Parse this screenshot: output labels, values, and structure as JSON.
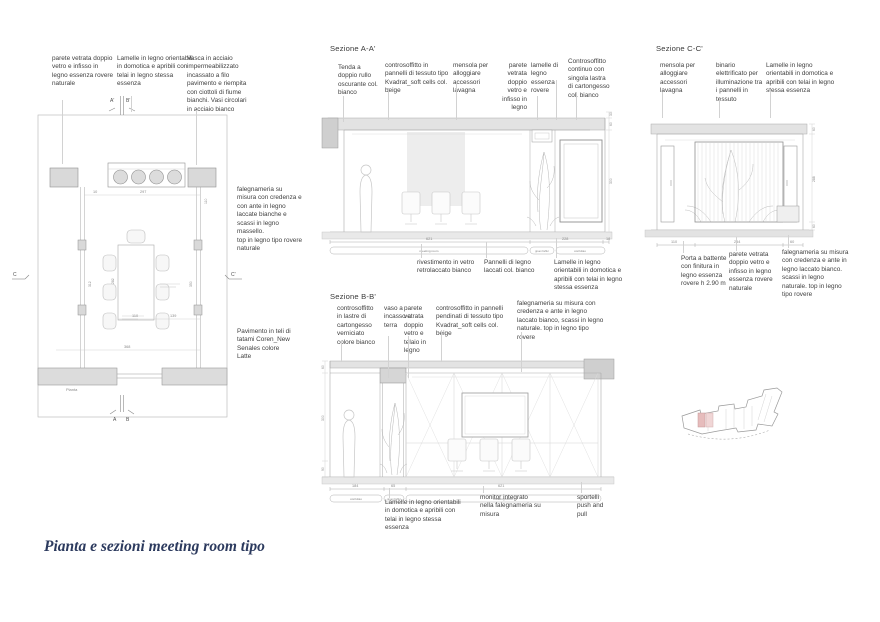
{
  "title": "Pianta e sezioni meeting room tipo",
  "colors": {
    "title_text": "#2c3a5e",
    "annotation_text": "#3f3f3f",
    "drawing_line": "#9a9a9a",
    "wall_fill": "#dcdcdc",
    "slab_fill": "#e3e3e3",
    "keyplan_highlight": "#e6bcbc"
  },
  "plan": {
    "label": "Pianta",
    "notes_top": [
      "parete vetrata doppio vetro e infisso in legno essenza rovere naturale",
      "Lamelle in legno orientabili in domotica e apribili con telai in legno stessa essenza",
      "Vasca in acciaio impermeabilizzato incassato a filo pavimento e riempita con ciottoli di fiume bianchi. Vasi circolari in acciaio bianco"
    ],
    "notes_right": [
      "falegnameria su misura con credenza e con ante in legno laccate bianche e scassi in legno massello.\ntop in legno tipo rovere naturale",
      "Pavimento in teli di tatami Coren_New Senales colore Latte"
    ],
    "marks": {
      "top": [
        "A'",
        "B'"
      ],
      "bottom": [
        "A",
        "B"
      ],
      "left": "C",
      "right": "C'"
    },
    "dims": {
      "top_small": "10",
      "top": "297",
      "right_top": "110",
      "table": "282",
      "left": "312",
      "right": "350",
      "bottom_a": "110",
      "bottom_b": "139",
      "bottom": "368"
    }
  },
  "section_a": {
    "label": "Sezione A-A'",
    "notes_top": [
      "Tenda a doppio rullo oscurante col. bianco",
      "controsoffitto in pannelli di tessuto tipo Kvadrat_soft cells col. beige",
      "mensola per alloggiare accessori lavagna",
      "parete vetrata doppio vetro e infisso in legno",
      "lamelle di legno essenza rovere",
      "Controsoffitto continuo con singola lastra di cartongesso col. bianco"
    ],
    "notes_bottom": [
      "rivestimento in vetro retrolaccato bianco",
      "Pannelli di legno laccati col. bianco",
      "Lamelle in legno orientabili in domotica e apribili con telai in legno stessa essenza"
    ],
    "dims_bottom": [
      "621",
      "228",
      "18"
    ],
    "dims_right": [
      "30",
      "60",
      "300"
    ],
    "zones": [
      "meeting room",
      "green buffer",
      "corridoio"
    ]
  },
  "section_b": {
    "label": "Sezione B-B'",
    "notes_top": [
      "controsoffitto in lastre di cartongesso verniciato colore bianco",
      "vaso a incasso a terra",
      "parete vetrata doppio vetro e telaio in legno",
      "controsoffitto in pannelli pendinati di tessuto tipo Kvadrat_soft cells col. beige",
      "falegnameria su misura con credenza e ante in legno laccato bianco, scassi in legno naturale. top in legno tipo rovere"
    ],
    "notes_bottom": [
      "Lamelle in legno orientabili in domotica e apribili con telai in legno stessa essenza",
      "monitor integrato nella falegnameria su misura",
      "sportelli push and pull"
    ],
    "dims_bottom": [
      "184",
      "65",
      "621"
    ],
    "dims_left": [
      "60",
      "300",
      "90"
    ],
    "zones": [
      "corridoio",
      "green buffer",
      "meeting room"
    ]
  },
  "section_c": {
    "label": "Sezione C-C'",
    "notes_top": [
      "mensola per alloggiare accessori lavagna",
      "binario elettrificato per illuminazione tra i pannelli in tessuto",
      "Lamelle in legno orientabili in domotica e apribili con telai in legno stessa essenza"
    ],
    "notes_bottom": [
      "Porta a battente con finitura in legno essenza rovere h 2.90 m",
      "parete vetrata doppio vetro e infisso in legno essenza rovere naturale",
      "falegnameria su misura con credenza e ante in legno laccato bianco. scassi in legno naturale. top in legno tipo rovere"
    ],
    "dims_bottom": [
      "110",
      "254",
      "60"
    ],
    "dims_right": [
      "60",
      "288",
      "60"
    ]
  }
}
